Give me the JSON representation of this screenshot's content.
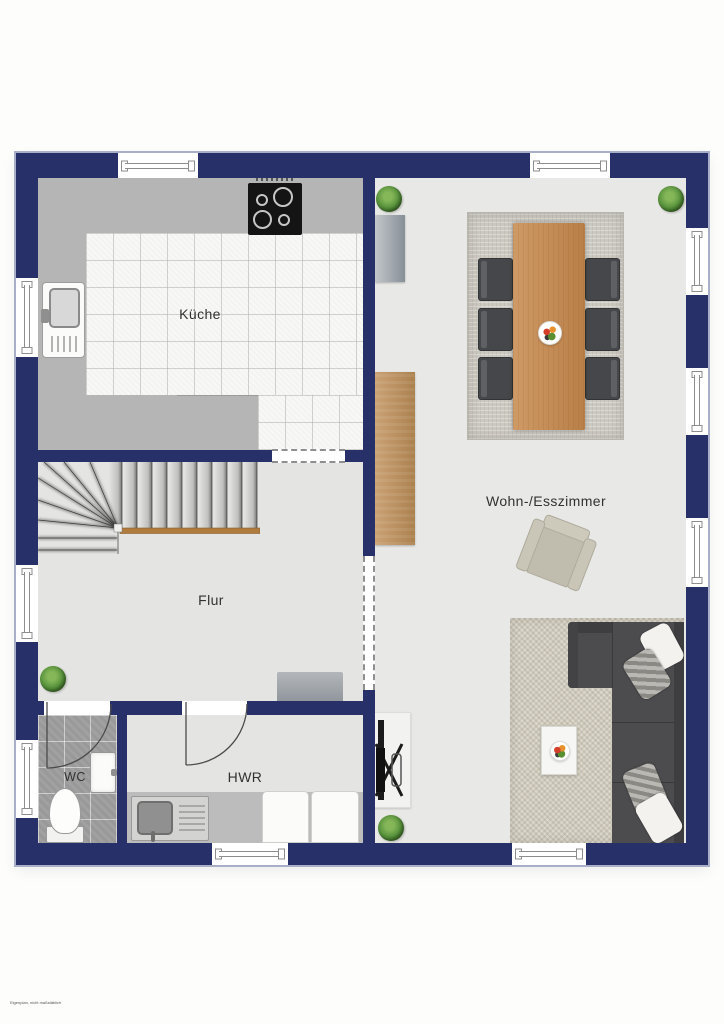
{
  "footnote": "Eigenplan, nicht maßstäblich",
  "rooms": {
    "kitchen": {
      "label": "Küche"
    },
    "hall": {
      "label": "Flur"
    },
    "wc": {
      "label": "WC"
    },
    "utility": {
      "label": "HWR"
    },
    "living_dining": {
      "label": "Wohn-/Esszimmer"
    }
  },
  "colors": {
    "wall": "#283069",
    "wall_outline": "#a9aec9",
    "kitchen_counter": "#b5b5b5",
    "kitchen_tiles": "#f8f8f6",
    "hall_floor": "#e4e4e2",
    "living_floor": "#e8e8e6",
    "wc_tiles": "#a1a1a1",
    "dining_table_wood": "#c28b59",
    "cabinet_wood": "#c09468",
    "stair_handrail": "#b07b3e",
    "sofa": "#4c4c4e",
    "dining_chair": "#45474a",
    "dining_rug": "#ccc9c1",
    "living_rug": "#cfcabb",
    "armchair": "#c8c4b6",
    "plant": "#4c8132"
  },
  "inventory": {
    "windows": 10,
    "door_swings": 2,
    "wall_openings": 2,
    "dining_chairs": 6,
    "plants": 4
  }
}
